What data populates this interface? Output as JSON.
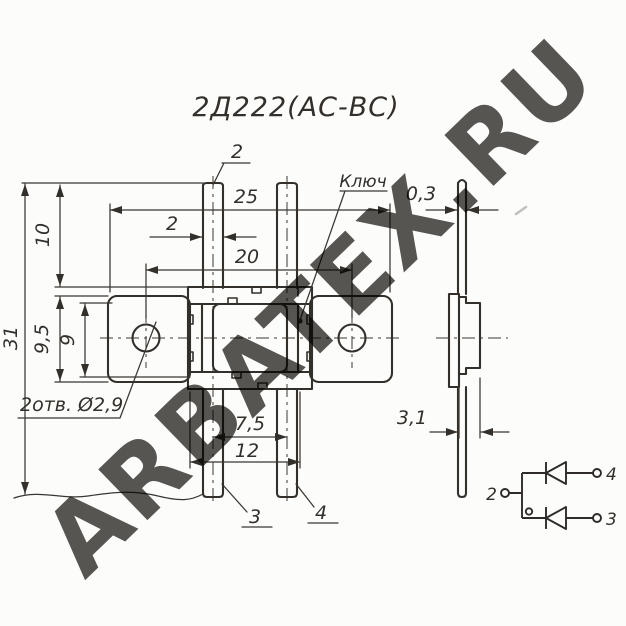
{
  "title": "2Д222(АС-ВС)",
  "watermark": "ARBATEX.RU",
  "front_view": {
    "pin2_label": "2",
    "key_label": "Ключ",
    "dim_overall_width": "25",
    "dim_lead_width": "2",
    "dim_hole_spacing": "20",
    "dim_lead_length": "10",
    "dim_overall_height": "31",
    "dim_tab_height": "9,5",
    "dim_body_height": "9",
    "holes_note": "2отв. Ø2,9",
    "dim_bottom_lead_spacing": "7,5",
    "dim_bottom_lead_span": "12",
    "pin3_label": "3",
    "pin4_label": "4"
  },
  "side_view": {
    "dim_lead_thickness": "0,3",
    "dim_body_thickness": "3,1"
  },
  "schematic": {
    "pin2_label": "2",
    "pin3_label": "3",
    "pin4_label": "4"
  },
  "colors": {
    "ink": "#33302b",
    "watermark_gradient_start": "#e0666a",
    "watermark_gradient_mid": "#f08a8a",
    "watermark_gradient_end": "#f8b4b0",
    "paper": "#fcfcfa"
  }
}
